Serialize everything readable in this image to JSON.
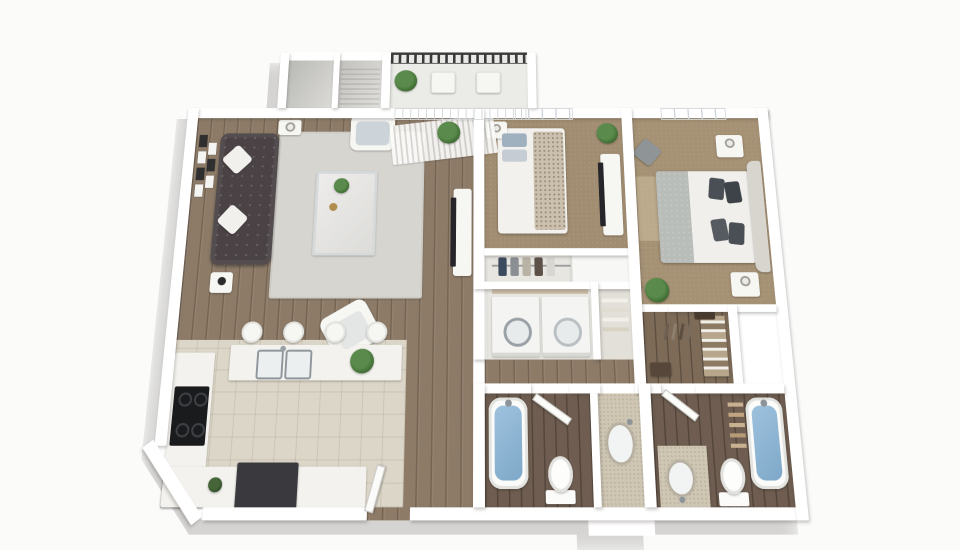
{
  "meta": {
    "title": "2 Bedroom 2 Bath Apartment - 3D Floor Plan Render",
    "view": "top-down 3D dollhouse perspective on plain light background",
    "visible_text": ""
  },
  "palette": {
    "bg": "#fbfbfa",
    "wall": "#ffffff",
    "wood": "#8d7b68",
    "bathfloor": "#6e5d50",
    "carpet": "#a18d71",
    "tile": "#dcd6c8",
    "tilebath": "#cfc7b4",
    "walkin": "#7d6b58",
    "closetfloor": "#e8e6e1",
    "rug": "#d7d5d0",
    "sofa": "#4a4245",
    "water": "#9ec2de",
    "railing": "#3a3a3a",
    "plant": "#5a8b4c",
    "plantdark": "#3c672f",
    "counter": "#f3f2ee",
    "appliance": "#3a3a3e",
    "dark": "#26262a",
    "headboard": "#d8d5cf",
    "blanket": "#b9bdb9",
    "pillowdark": "#4a4f55",
    "throw": "#cbbfae"
  },
  "rooms": {
    "living": {
      "label": "Living Room",
      "floor": "hardwood"
    },
    "kitchen": {
      "label": "Kitchen",
      "floor": "tile"
    },
    "bedroom1": {
      "label": "Bedroom 1",
      "floor": "carpet"
    },
    "bedroom2": {
      "label": "Bedroom 2",
      "floor": "carpet"
    },
    "bathroom1": {
      "label": "Bathroom 1",
      "floor": "dark hardwood"
    },
    "bathroom2": {
      "label": "Bathroom 2",
      "floor": "dark hardwood"
    },
    "walkin": {
      "label": "Walk-in Closet",
      "floor": "dark hardwood"
    },
    "laundry": {
      "label": "Laundry Closet"
    },
    "linen": {
      "label": "Linen Closet"
    },
    "closet1": {
      "label": "Bedroom 1 Closet"
    },
    "hall": {
      "label": "Hallway",
      "floor": "hardwood"
    },
    "vanity": {
      "label": "Vanity Nook",
      "floor": "tile"
    },
    "balcony": {
      "label": "Balcony"
    },
    "storage": {
      "label": "Storage Closets"
    },
    "entry": {
      "label": "Entry Door"
    }
  },
  "furniture": {
    "living": [
      "tufted sofa with two white pillows",
      "area rug",
      "glass coffee table with plant",
      "white armchair x2",
      "side tables with lamps",
      "tv console with flat tv",
      "gallery wall art",
      "floor plant"
    ],
    "kitchen": [
      "island with double sink and plant",
      "four bar stools",
      "black cooktop",
      "dark dishwasher",
      "l-shaped counters"
    ],
    "bedroom1": [
      "queen bed with textured throw",
      "nightstand with lamp",
      "dresser with tv",
      "potted plant",
      "open closet with clothes"
    ],
    "bedroom2": [
      "queen bed with upholstered headboard",
      "two nightstands with lamps",
      "gray accent seat",
      "potted plant",
      "rug"
    ],
    "bathroom1": [
      "bathtub with water",
      "toilet",
      "oval sink on tiled counter",
      "open door"
    ],
    "bathroom2": [
      "bathtub with water",
      "toilet",
      "vanity with sink",
      "towel ladder",
      "open door"
    ],
    "laundry": [
      "washer",
      "dryer",
      "shelf with supplies"
    ],
    "walkin": [
      "shelving with folded clothes",
      "hanging rod",
      "bench"
    ],
    "balcony": [
      "metal railing",
      "two chairs",
      "potted plant"
    ]
  }
}
